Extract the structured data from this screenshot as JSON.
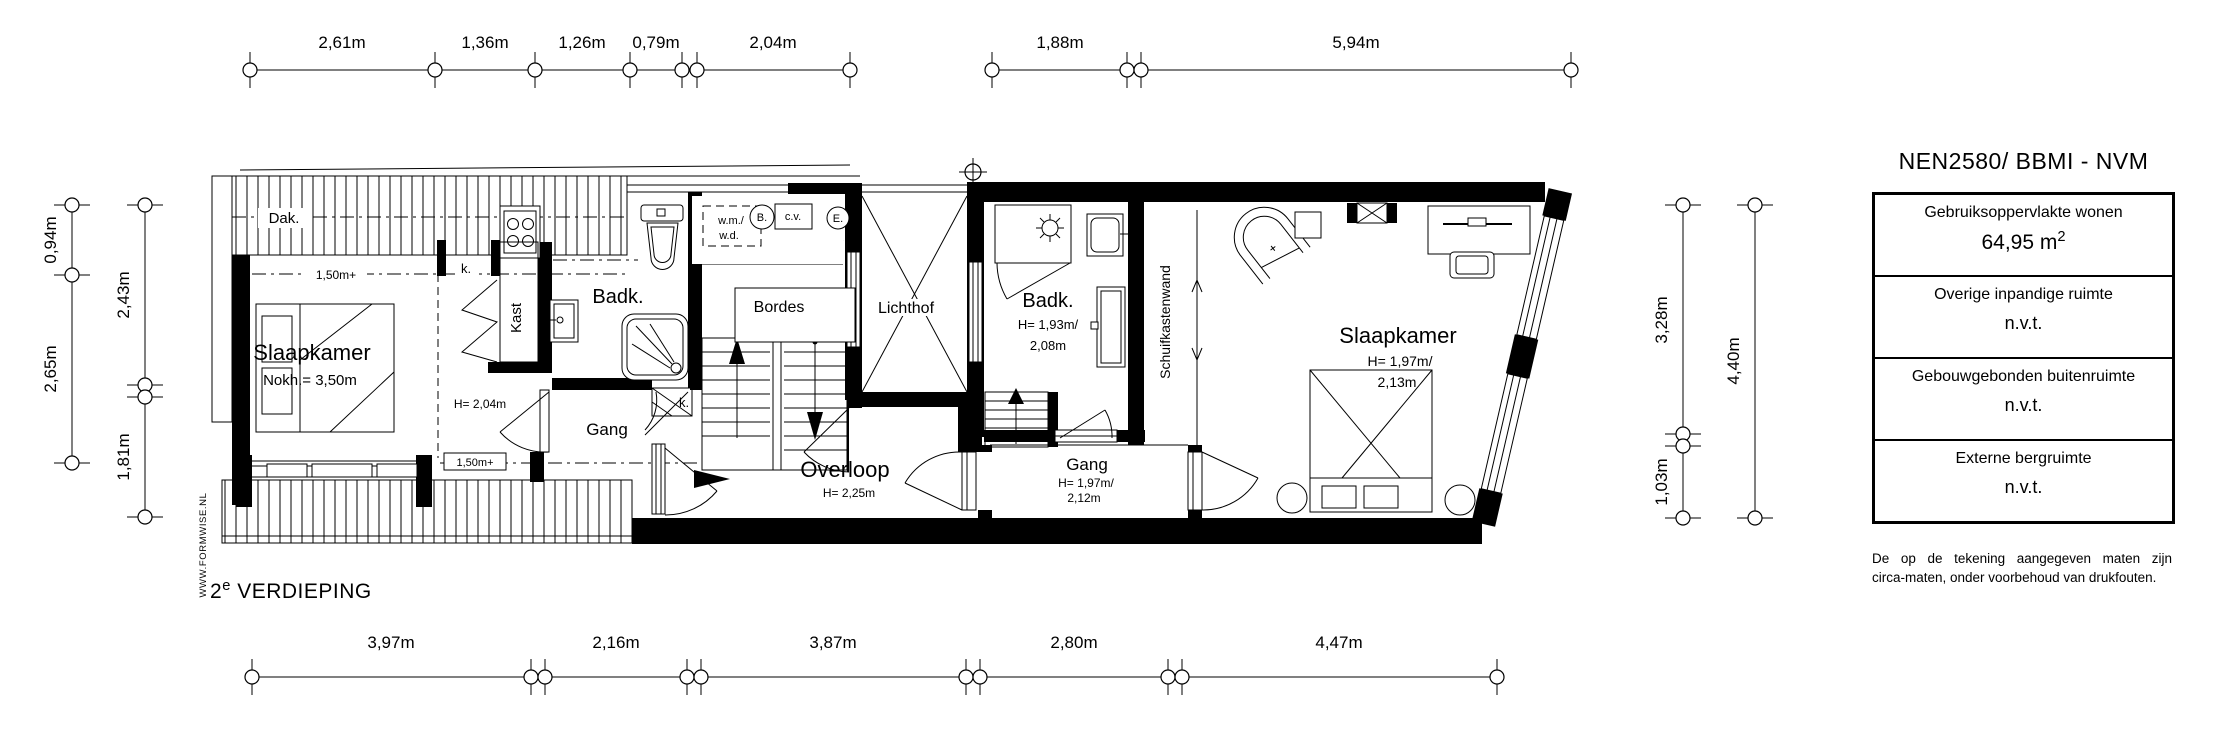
{
  "floorplan": {
    "rooms": {
      "slaapkamer_left": {
        "name": "Slaapkamer",
        "note": "Nokh.= 3,50m"
      },
      "badk_left": {
        "name": "Badk."
      },
      "kast": {
        "name": "Kast"
      },
      "gang_left": {
        "name": "Gang"
      },
      "overloop": {
        "name": "Overloop",
        "note": "H= 2,25m"
      },
      "bordes": {
        "name": "Bordes"
      },
      "lichthof": {
        "name": "Lichthof"
      },
      "badk_right": {
        "name": "Badk.",
        "note1": "H= 1,93m/",
        "note2": "2,08m"
      },
      "schuifkastenwand": {
        "name": "Schuifkastenwand"
      },
      "gang_right": {
        "name": "Gang",
        "note1": "H= 1,97m/",
        "note2": "2,12m"
      },
      "slaapkamer_right": {
        "name": "Slaapkamer",
        "note1": "H= 1,97m/",
        "note2": "2,13m"
      }
    },
    "annotations": {
      "dak": "Dak.",
      "ridge_line_1": "1,50m+",
      "ridge_line_2": "1,50m+",
      "k_small_1": "k.",
      "k_small_2": "k.",
      "h_204": "H= 2,04m",
      "wm": "w.m./",
      "wd": "w.d.",
      "boiler": "B.",
      "cv": "c.v.",
      "electric": "E."
    },
    "dimensions": {
      "top": [
        "2,61m",
        "1,36m",
        "1,26m",
        "0,79m",
        "2,04m",
        "1,88m",
        "5,94m"
      ],
      "bottom": [
        "3,97m",
        "2,16m",
        "3,87m",
        "2,80m",
        "4,47m"
      ],
      "left_outer": [
        "0,94m",
        "2,65m"
      ],
      "left_inner": [
        "2,43m",
        "1,81m"
      ],
      "right_inner": [
        "3,28m",
        "1,03m"
      ],
      "right_outer": [
        "4,40m"
      ]
    },
    "floor_label": {
      "prefix": "2",
      "sup": "e",
      "name": "VERDIEPING"
    },
    "watermark": "WWW.FORMWISE.NL"
  },
  "legend": {
    "title": "NEN2580/ BBMI - NVM",
    "rows": [
      {
        "label": "Gebruiksoppervlakte wonen",
        "value": "64,95 m",
        "sup": "2"
      },
      {
        "label": "Overige inpandige ruimte",
        "value": "n.v.t."
      },
      {
        "label": "Gebouwgebonden buitenruimte",
        "value": "n.v.t."
      },
      {
        "label": "Externe bergruimte",
        "value": "n.v.t."
      }
    ],
    "disclaimer_line1": "De op de tekening aangegeven maten zijn",
    "disclaimer_line2": "circa-maten, onder voorbehoud van drukfouten."
  }
}
